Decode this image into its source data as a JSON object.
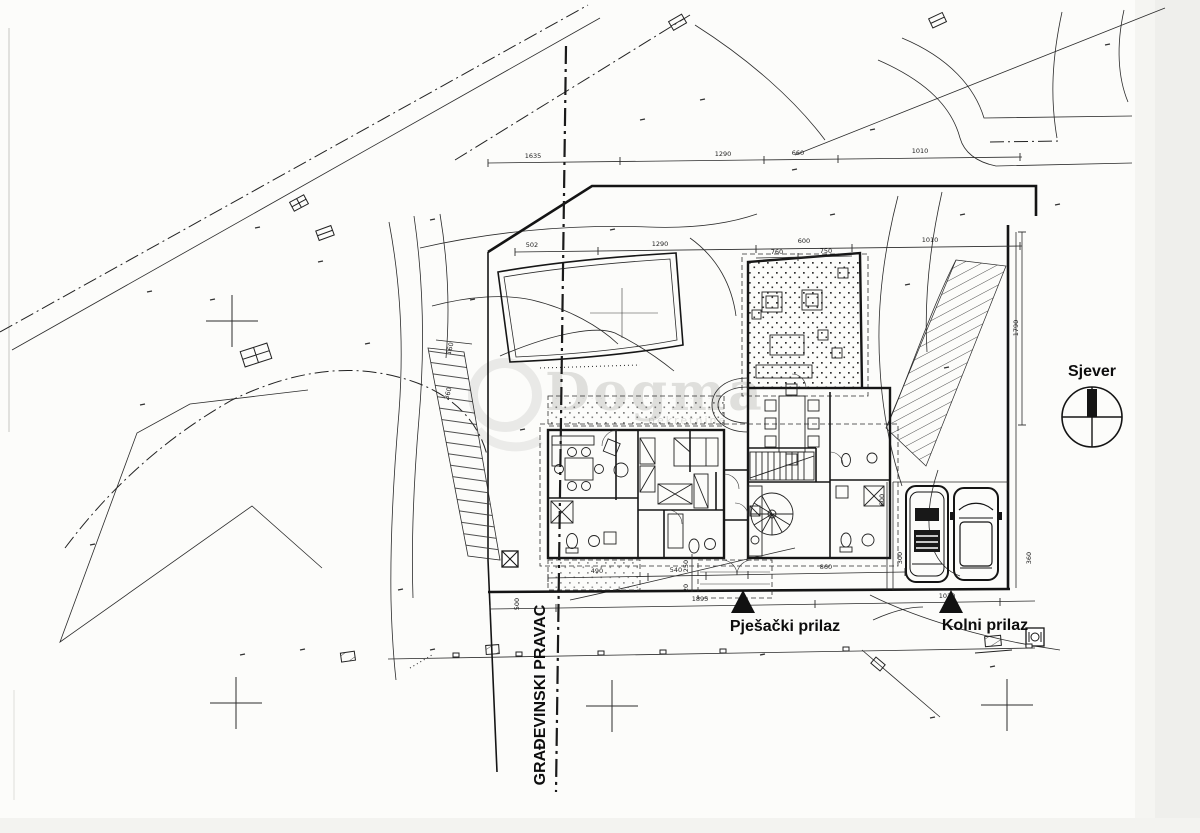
{
  "labels": {
    "north": "Sjever",
    "pedestrian_access": "Pješački prilaz",
    "vehicle_access": "Kolni prilaz",
    "building_line": "GRAĐEVINSKI PRAVAC"
  },
  "watermark": {
    "text": "Dogma",
    "subtext": "nekretnine"
  },
  "dimensions": {
    "top_row": [
      "1635",
      "1290",
      "660",
      "1010"
    ],
    "site_row": [
      "502",
      "1290",
      "600",
      "1010"
    ],
    "site_row_sub": [
      "760",
      "750"
    ],
    "house_row": [
      "490",
      "540",
      "860"
    ],
    "house_row_vertical": [
      "250",
      "20"
    ],
    "access_row": [
      "1895",
      "1010"
    ],
    "access_row_vertical": [
      "500"
    ],
    "right_vertical": [
      "1790"
    ],
    "parking_vertical": [
      "600",
      "300",
      "360"
    ],
    "wall_vertical": [
      "160",
      "360"
    ]
  },
  "colors": {
    "ink": "#1c1c1c",
    "paper": "#fcfcfa",
    "watermark": "#b9b9b4"
  }
}
